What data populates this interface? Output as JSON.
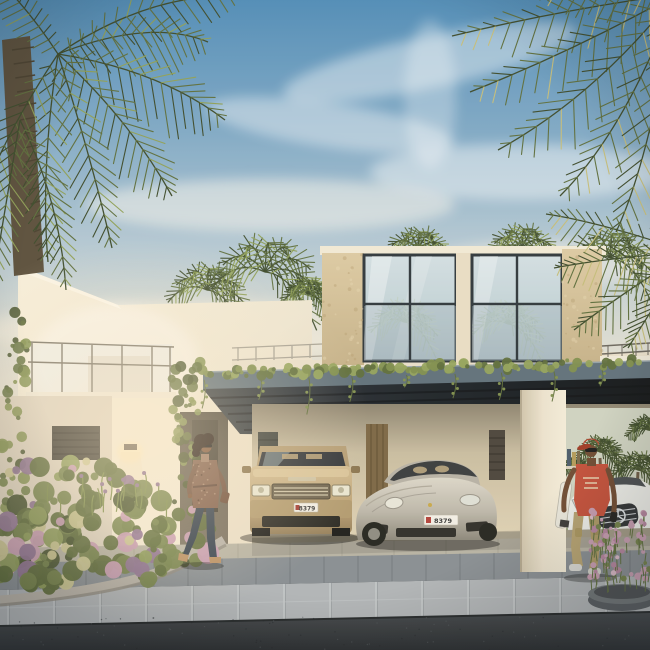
{
  "scene": {
    "type": "architectural rendering",
    "subject": "Modern two-storey villa with double carport",
    "setting": "tropical residential street in warm late-afternoon light"
  },
  "palette": {
    "sky_top": "#4f8cb8",
    "sky_mid": "#a9c4d3",
    "sky_horizon": "#efe6d4",
    "cloud": "#ffffff",
    "palm_dark": "#3c4a2b",
    "palm_mid": "#5d6e3d",
    "palm_light": "#8fa057",
    "palm_gold": "#c4bd7a",
    "trunk": "#5a4f3c",
    "wall_white": "#efe6d2",
    "wall_lit": "#f8f0dc",
    "wall_shadow": "#ddd2bf",
    "stone_pier": "#d7c49d",
    "pier_center": "#e9dec6",
    "roof_band": "#f2ead6",
    "glass": "#c7d6dc",
    "frame": "#2e363c",
    "canopy": "#5f707b",
    "soffit": "#1a1f24",
    "vine": "#5e6e3c",
    "vine_light": "#7f8f4e",
    "interior": "#d9cbae",
    "interior_dark": "#9a8f77",
    "column": "#ece3cf",
    "door_wood": "#7c6745",
    "louver": "#3b403b",
    "suv_body": "#c2ab80",
    "suv_dark": "#8f7a55",
    "windshield": "#2f3338",
    "sedan_body": "#cfcabd",
    "sedan_dark": "#8f8a7e",
    "merc_body": "#eceee9",
    "skin_woman": "#7a5238",
    "skin_man": "#6e4a32",
    "hair": "#221813",
    "tunic": "#7d5a48",
    "jeans": "#2e3a49",
    "heels": "#b98f63",
    "cap_red": "#b8422c",
    "shirt_red": "#c3503a",
    "pants_khaki": "#b5a271",
    "sneaker": "#d9d9d4",
    "bush1": "#5c6a3a",
    "bush2": "#72814a",
    "bush3": "#8b9a58",
    "bush_dark": "#46522e",
    "bloom_cream": "#c9c491",
    "bloom_purple": "#8d7191",
    "bloom_pink": "#c79cb2",
    "curb": "#b7b2a8",
    "band_granite": "#878e93",
    "band_paver": "#b0b5b8",
    "apron": "#b7b3a4",
    "asphalt": "#42474b",
    "asphalt_deep": "#282c30",
    "plate_white": "#f2efe6",
    "plate_text": "#3a3a3a",
    "lamp_glow": "#f5d9a0"
  },
  "villa": {
    "storeys": "2",
    "walls": "warm white render with sandstone piers",
    "upper_floor": "full-height glazed lounge",
    "balcony": "glass-railing balcony",
    "canopy": "slate-grey carport canopy with trailing vines"
  },
  "vehicles": {
    "suv": {
      "type": "luxury SUV",
      "colour": "champagne gold",
      "plate": "8379"
    },
    "sedan": {
      "type": "sports saloon",
      "colour": "silver",
      "plate": "8379"
    },
    "background_car": {
      "type": "luxury saloon",
      "colour": "white",
      "emblem": "three-pointed star"
    }
  },
  "people": {
    "woman": {
      "action": "walking past the entrance",
      "outfit": "patterned brown tunic, dark jeans, tan heels, sunglasses"
    },
    "man": {
      "action": "walking out of the carport",
      "outfit": "red cap, red graphic tee, khaki trousers, white board in hand"
    }
  },
  "landscaping": {
    "left_bed": "mixed shrubs with lavender and cream blooms",
    "right_bowl": "round stone planter with pink flower spikes"
  },
  "ground": {
    "apron": "grey granite pavers",
    "road": "dark asphalt"
  }
}
